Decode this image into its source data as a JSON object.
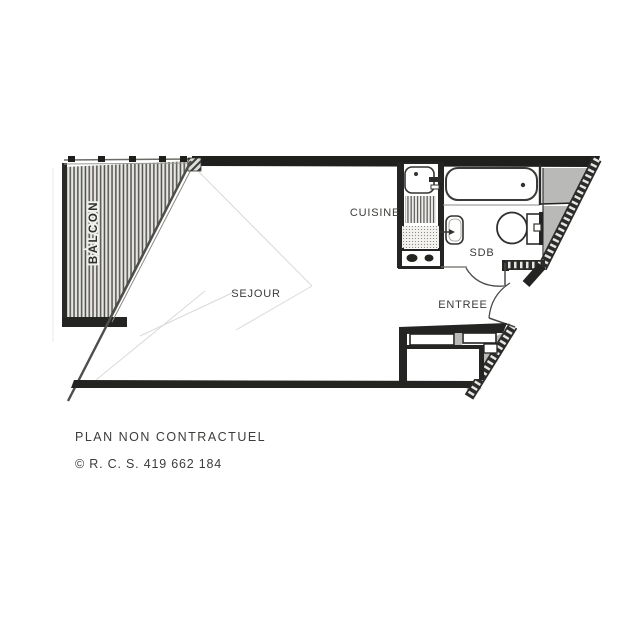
{
  "plan": {
    "labels": {
      "balcon": "BALCON",
      "sejour": "SEJOUR",
      "cuisine": "CUISINE",
      "sdb": "SDB",
      "entree": "ENTREE"
    }
  },
  "footer": {
    "disclaimer": "PLAN NON CONTRACTUEL",
    "copyright": "© R. C. S. 419 662 184"
  },
  "colors": {
    "wall": "#242422",
    "poche": "#b9b9b7",
    "hatch_dark": "#2c2c2a",
    "label_text": "#3b3b39",
    "background": "#ffffff"
  }
}
